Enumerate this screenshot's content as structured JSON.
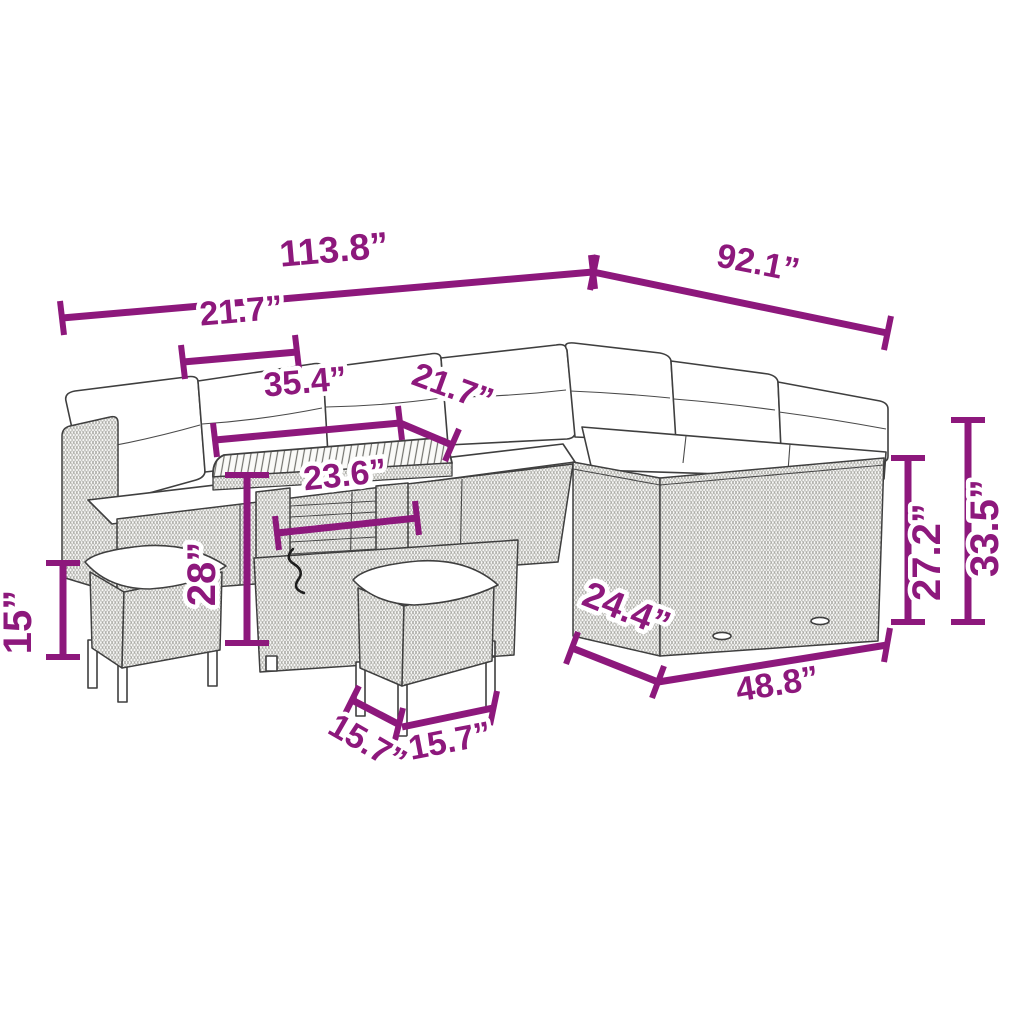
{
  "diagram": {
    "type": "product-dimension-diagram",
    "subject": "outdoor poly rattan corner lounge set with storage table and two stools",
    "unit": "inches",
    "colors": {
      "dimension_accent": "#8d187c",
      "outline": "#3f3f3f",
      "background": "#ffffff"
    },
    "dimensions": {
      "overall_width_left": "113.8”",
      "overall_width_right": "92.1”",
      "left_section_width": "21.7”",
      "table_section_width": "35.4”",
      "corner_section_width": "21.7”",
      "table_top_length": "23.6”",
      "table_height": "28”",
      "stool_height": "15”",
      "sofa_depth": "24.4”",
      "right_sofa_length": "48.8”",
      "backrest_height": "27.2”",
      "overall_height": "33.5”",
      "stool_depth": "15.7”",
      "stool_width": "15.7”"
    }
  }
}
